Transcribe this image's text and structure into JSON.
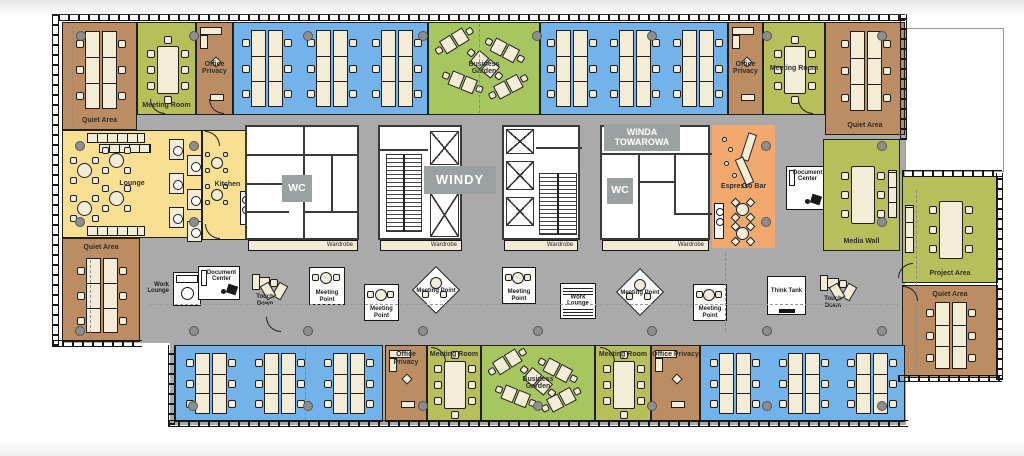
{
  "colors": {
    "brown": "#bc8d62",
    "green": "#b7bf5b",
    "garden": "#a6c75f",
    "blue": "#74b3e9",
    "yellow": "#f9df92",
    "orange": "#f3a96d",
    "gray": "#aaaaaa",
    "cream": "#f3ecd7",
    "labelbox": "#9ba1a1"
  },
  "rooms": [
    {
      "id": "quiet-area-nw",
      "label": "Quiet Area",
      "color": "brown",
      "x": 62,
      "y": 22,
      "w": 75,
      "h": 108,
      "labelPos": "bottom",
      "type": "cluster1"
    },
    {
      "id": "meeting-room-1",
      "label": "Meeting Room",
      "color": "green",
      "x": 137,
      "y": 22,
      "w": 59,
      "h": 93,
      "labelPos": "bottom",
      "type": "meeting"
    },
    {
      "id": "office-privacy-1",
      "label": "Office Privacy",
      "color": "brown",
      "x": 196,
      "y": 22,
      "w": 37,
      "h": 93,
      "labelPos": "mid",
      "type": "office"
    },
    {
      "id": "open-office-n1",
      "label": "",
      "color": "blue",
      "x": 233,
      "y": 22,
      "w": 195,
      "h": 93,
      "labelPos": "",
      "type": "clusters3"
    },
    {
      "id": "business-garden-n",
      "label": "Business Garden",
      "color": "garden",
      "x": 428,
      "y": 22,
      "w": 112,
      "h": 93,
      "labelPos": "center",
      "type": "garden"
    },
    {
      "id": "open-office-n2",
      "label": "",
      "color": "blue",
      "x": 540,
      "y": 22,
      "w": 188,
      "h": 93,
      "labelPos": "",
      "type": "clusters3"
    },
    {
      "id": "office-privacy-2",
      "label": "Office Privacy",
      "color": "brown",
      "x": 728,
      "y": 22,
      "w": 35,
      "h": 93,
      "labelPos": "mid",
      "type": "office"
    },
    {
      "id": "meeting-room-2",
      "label": "Meeting Room",
      "color": "green",
      "x": 763,
      "y": 22,
      "w": 62,
      "h": 93,
      "labelPos": "mid",
      "type": "meeting"
    },
    {
      "id": "quiet-area-ne",
      "label": "Quiet Area",
      "color": "brown",
      "x": 825,
      "y": 22,
      "w": 80,
      "h": 113,
      "labelPos": "bottom",
      "type": "cluster1"
    },
    {
      "id": "lounge",
      "label": "Lounge",
      "color": "yellow",
      "x": 62,
      "y": 130,
      "w": 140,
      "h": 108,
      "labelPos": "center",
      "type": "lounge"
    },
    {
      "id": "kitchen",
      "label": "Kitchen",
      "color": "yellow",
      "x": 202,
      "y": 130,
      "w": 51,
      "h": 110,
      "labelPos": "center",
      "type": "kitchen"
    },
    {
      "id": "quiet-area-sw",
      "label": "Quiet Area",
      "color": "brown",
      "x": 62,
      "y": 238,
      "w": 78,
      "h": 104,
      "labelPos": "top",
      "type": "cluster1"
    },
    {
      "id": "espresso-bar",
      "label": "Espresso Bar",
      "color": "orange",
      "x": 712,
      "y": 125,
      "w": 63,
      "h": 123,
      "labelPos": "center",
      "type": "espresso",
      "noBorder": true
    },
    {
      "id": "media-wall",
      "label": "Media Wall",
      "color": "green",
      "x": 823,
      "y": 139,
      "w": 77,
      "h": 112,
      "labelPos": "bottom",
      "type": "meeting6"
    },
    {
      "id": "project-area",
      "label": "Project Area",
      "color": "green",
      "x": 902,
      "y": 176,
      "w": 96,
      "h": 107,
      "labelPos": "bottom",
      "type": "meeting6"
    },
    {
      "id": "quiet-area-se",
      "label": "Quiet Area",
      "color": "brown",
      "x": 902,
      "y": 285,
      "w": 96,
      "h": 93,
      "labelPos": "top",
      "type": "cluster1"
    },
    {
      "id": "open-office-s1",
      "label": "",
      "color": "blue",
      "x": 175,
      "y": 345,
      "w": 208,
      "h": 77,
      "labelPos": "",
      "type": "clusters3"
    },
    {
      "id": "office-privacy-3",
      "label": "Office Privacy",
      "color": "brown",
      "x": 385,
      "y": 345,
      "w": 42,
      "h": 77,
      "labelPos": "top",
      "type": "office"
    },
    {
      "id": "meeting-room-3",
      "label": "Meeting Room",
      "color": "green",
      "x": 427,
      "y": 345,
      "w": 54,
      "h": 77,
      "labelPos": "top",
      "type": "meeting"
    },
    {
      "id": "business-garden-s",
      "label": "Business Garden",
      "color": "garden",
      "x": 481,
      "y": 345,
      "w": 114,
      "h": 77,
      "labelPos": "center",
      "type": "garden"
    },
    {
      "id": "meeting-room-4",
      "label": "Meeting Room",
      "color": "green",
      "x": 595,
      "y": 345,
      "w": 56,
      "h": 77,
      "labelPos": "top",
      "type": "meeting"
    },
    {
      "id": "office-privacy-4",
      "label": "Office Privacy",
      "color": "brown",
      "x": 651,
      "y": 345,
      "w": 49,
      "h": 77,
      "labelPos": "top",
      "type": "office"
    },
    {
      "id": "open-office-s2",
      "label": "",
      "color": "blue",
      "x": 700,
      "y": 345,
      "w": 205,
      "h": 77,
      "labelPos": "",
      "type": "clusters3"
    }
  ],
  "pods": [
    {
      "id": "work-lounge-1",
      "label": "Work Lounge",
      "type": "copier",
      "x": 173,
      "y": 272,
      "w": 28,
      "h": 34
    },
    {
      "id": "document-center-1",
      "label": "Document Center",
      "type": "doccenter",
      "x": 198,
      "y": 266,
      "w": 42,
      "h": 34
    },
    {
      "id": "touch-down-1",
      "label": "Touch Down",
      "type": "touchdown",
      "x": 252,
      "y": 266,
      "w": 38,
      "h": 40
    },
    {
      "id": "meeting-point-1",
      "label": "Meeting Point",
      "type": "square",
      "x": 309,
      "y": 267,
      "w": 36,
      "h": 38
    },
    {
      "id": "meeting-point-2",
      "label": "Meeting Point",
      "type": "square",
      "x": 364,
      "y": 284,
      "w": 35,
      "h": 37
    },
    {
      "id": "meeting-point-3",
      "label": "Meeting Point",
      "type": "diamond",
      "x": 412,
      "y": 266,
      "w": 48,
      "h": 48
    },
    {
      "id": "meeting-point-4",
      "label": "Meeting Point",
      "type": "square",
      "x": 502,
      "y": 267,
      "w": 34,
      "h": 37
    },
    {
      "id": "work-lounge-2",
      "label": "Work Lounge",
      "type": "stripes",
      "x": 560,
      "y": 283,
      "w": 36,
      "h": 36
    },
    {
      "id": "meeting-point-5",
      "label": "Meeting Point",
      "type": "diamond",
      "x": 616,
      "y": 268,
      "w": 48,
      "h": 48
    },
    {
      "id": "meeting-point-6",
      "label": "Meeting Point",
      "type": "square",
      "x": 693,
      "y": 284,
      "w": 34,
      "h": 37
    },
    {
      "id": "think-tank",
      "label": "Think Tank",
      "type": "plain",
      "x": 767,
      "y": 276,
      "w": 39,
      "h": 39
    },
    {
      "id": "touch-down-2",
      "label": "Touch Down",
      "type": "touchdown",
      "x": 820,
      "y": 266,
      "w": 40,
      "h": 42
    },
    {
      "id": "document-center-2",
      "label": "Document Center",
      "type": "doccenter",
      "x": 786,
      "y": 166,
      "w": 38,
      "h": 44
    }
  ],
  "coreLabels": {
    "wcWest": "WC",
    "wcEast": "WC",
    "windy": "WINDY",
    "winda": "WINDA TOWAROWA"
  },
  "wardrobes": [
    {
      "label": "Wardrobe"
    },
    {
      "label": "Wardrobe"
    },
    {
      "label": "Wardrobe"
    },
    {
      "label": "Wardrobe"
    }
  ]
}
